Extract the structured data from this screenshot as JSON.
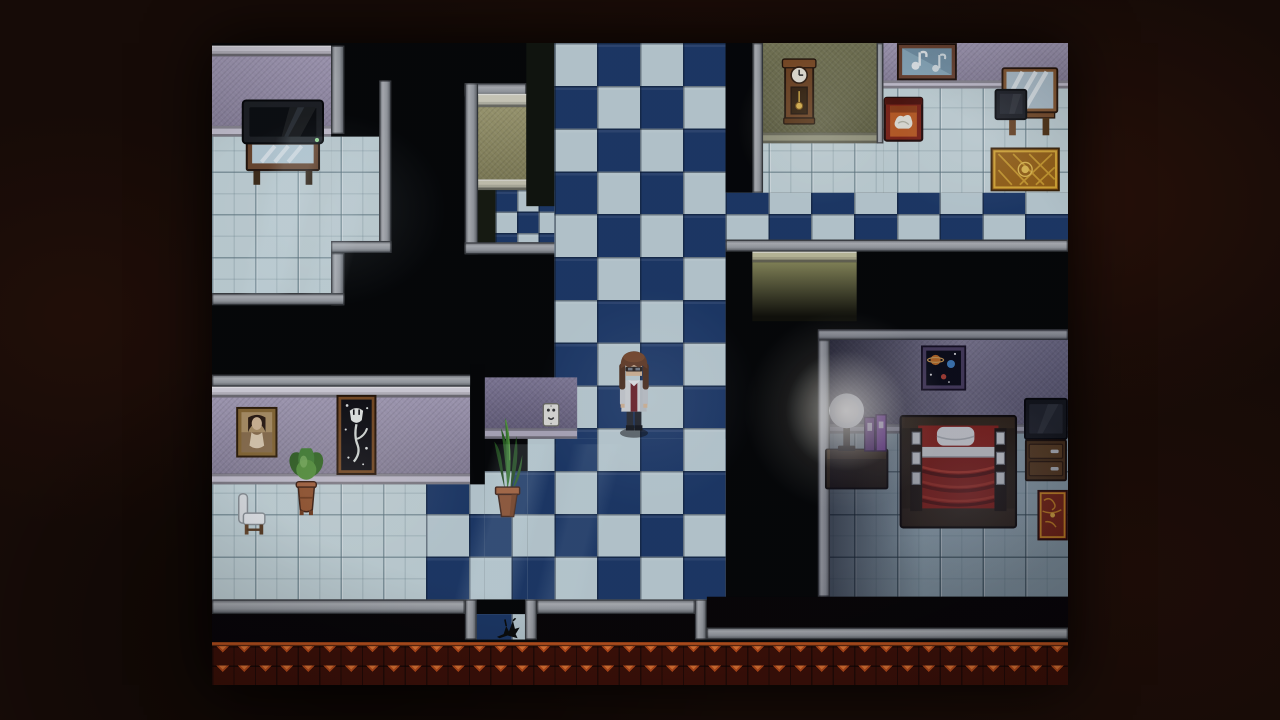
{
  "window": {
    "width": 1280,
    "height": 720,
    "game": {
      "x": 212,
      "y": 43,
      "w": 856,
      "h": 642,
      "native_w": 640,
      "native_h": 480,
      "scale": 1.3375
    }
  },
  "palette": {
    "letterbox": "#160b07",
    "void": "#050606",
    "checker_navy": "#1d3a6a",
    "checker_pale": "#c2d4da",
    "floor_pale": "#c9dade",
    "floor_olive": "#8f8f5e",
    "floor_dim": "#93a8b2",
    "wall_lavender": "#a79dbb",
    "wall_olive": "#70704a",
    "wall_bedroom_dark": "#3a3950",
    "wall_bedroom_light": "#8a84a0",
    "gray_border": "#a4a8ad",
    "roof_base": "#401005",
    "roof_shingle": "#c44e18",
    "roof_line": "#c8561c",
    "lamp_glow": "#fffaeb"
  },
  "regions": [
    {
      "name": "tvroom-wall-molding",
      "kind": "molding",
      "x": 0,
      "y": 2,
      "w": 89,
      "h": 8,
      "c": "#dbd8e2"
    },
    {
      "name": "tvroom-wall",
      "kind": "wall",
      "x": 0,
      "y": 10,
      "w": 89,
      "h": 52,
      "c": "#a79dbb"
    },
    {
      "name": "tvroom-wall-baseboard",
      "kind": "base",
      "x": 0,
      "y": 62,
      "w": 89,
      "h": 8,
      "c": "#ccc8d6"
    },
    {
      "name": "tvroom-wall-edge",
      "kind": "border",
      "o": "v",
      "x": 89,
      "y": 2,
      "w": 10,
      "h": 66
    },
    {
      "name": "tvroom-floor",
      "kind": "floor",
      "c": "pale",
      "x": 0,
      "y": 70,
      "w": 89,
      "h": 117
    },
    {
      "name": "tvroom-floor-ext",
      "kind": "floor",
      "c": "pale",
      "x": 89,
      "y": 70,
      "w": 36,
      "h": 80
    },
    {
      "name": "tvroom-border-right-upper",
      "kind": "border",
      "o": "v",
      "x": 125,
      "y": 28,
      "w": 9,
      "h": 129
    },
    {
      "name": "tvroom-border-step",
      "kind": "border",
      "o": "h",
      "x": 89,
      "y": 148,
      "w": 45,
      "h": 9
    },
    {
      "name": "tvroom-border-right-lower",
      "kind": "border",
      "o": "v",
      "x": 89,
      "y": 157,
      "w": 10,
      "h": 39
    },
    {
      "name": "tvroom-border-bottom",
      "kind": "border",
      "o": "h",
      "x": 0,
      "y": 187,
      "w": 99,
      "h": 9
    },
    {
      "name": "alcove-border-top",
      "kind": "border",
      "o": "h",
      "x": 189,
      "y": 30,
      "w": 46,
      "h": 10
    },
    {
      "name": "alcove-border-left",
      "kind": "border",
      "o": "v",
      "x": 189,
      "y": 30,
      "w": 10,
      "h": 128
    },
    {
      "name": "alcove-window-molding",
      "kind": "molding",
      "x": 199,
      "y": 38,
      "w": 36,
      "h": 10,
      "c": "#d8d6c4"
    },
    {
      "name": "alcove-window-wall",
      "kind": "wall",
      "x": 199,
      "y": 48,
      "w": 36,
      "h": 54,
      "c": "#9c9868"
    },
    {
      "name": "alcove-window-sill",
      "kind": "molding",
      "x": 199,
      "y": 102,
      "w": 36,
      "h": 8,
      "c": "#cfcdb8"
    },
    {
      "name": "alcove-dark-floor",
      "kind": "black",
      "x": 199,
      "y": 110,
      "w": 19,
      "h": 39,
      "c": "#171b10"
    },
    {
      "name": "alcove-checker",
      "kind": "checker16",
      "x": 212,
      "y": 110,
      "w": 44,
      "h": 39
    },
    {
      "name": "alcove-border-bottom",
      "kind": "border",
      "o": "h",
      "x": 189,
      "y": 149,
      "w": 84,
      "h": 9
    },
    {
      "name": "corridor-dark-strip",
      "kind": "black",
      "x": 235,
      "y": 0,
      "w": 21,
      "h": 122,
      "c": "#10140c"
    },
    {
      "name": "main-corridor-floor",
      "kind": "checker",
      "x": 256,
      "y": 0,
      "w": 128,
      "h": 416
    },
    {
      "name": "clockroom-notch",
      "kind": "black",
      "x": 384,
      "y": 0,
      "w": 20,
      "h": 112,
      "c": "#040506"
    },
    {
      "name": "clockroom-border-left",
      "kind": "border",
      "o": "v",
      "x": 404,
      "y": 0,
      "w": 8,
      "h": 112
    },
    {
      "name": "clockroom-wall",
      "kind": "wall",
      "x": 412,
      "y": 0,
      "w": 85,
      "h": 67,
      "c": "#70704a"
    },
    {
      "name": "clockroom-wall-baseboard",
      "kind": "base",
      "x": 412,
      "y": 67,
      "w": 85,
      "h": 8,
      "c": "#9a9a80"
    },
    {
      "name": "clockroom-floor",
      "kind": "floor",
      "c": "pale",
      "x": 412,
      "y": 75,
      "w": 90,
      "h": 37
    },
    {
      "name": "room-divider-edge",
      "kind": "border",
      "o": "v",
      "x": 497,
      "y": 0,
      "w": 5,
      "h": 75
    },
    {
      "name": "dresserroom-wall",
      "kind": "wall",
      "x": 502,
      "y": 0,
      "w": 138,
      "h": 28,
      "c": "#a79dbb"
    },
    {
      "name": "dresserroom-wall-baseboard",
      "kind": "base",
      "x": 502,
      "y": 28,
      "w": 138,
      "h": 6,
      "c": "#ccc8d6"
    },
    {
      "name": "dresserroom-floor",
      "kind": "floor",
      "c": "pale",
      "x": 502,
      "y": 34,
      "w": 138,
      "h": 78
    },
    {
      "name": "east-corridor-floor",
      "kind": "checker",
      "x": 384,
      "y": 112,
      "w": 256,
      "h": 35
    },
    {
      "name": "east-corridor-border",
      "kind": "border",
      "o": "h",
      "x": 384,
      "y": 147,
      "w": 256,
      "h": 9
    },
    {
      "name": "clockroom-southface-molding",
      "kind": "molding",
      "x": 404,
      "y": 156,
      "w": 78,
      "h": 8,
      "c": "#c6c4a0"
    },
    {
      "name": "clockroom-southface",
      "kind": "face",
      "x": 404,
      "y": 164,
      "w": 78,
      "h": 44,
      "c": "#8a8a5a"
    },
    {
      "name": "bedroom-border-top",
      "kind": "border",
      "o": "h",
      "x": 453,
      "y": 214,
      "w": 187,
      "h": 8
    },
    {
      "name": "bedroom-border-left",
      "kind": "border",
      "o": "v",
      "x": 453,
      "y": 222,
      "w": 9,
      "h": 192
    },
    {
      "name": "bedroom-wall",
      "kind": "wall",
      "x": 462,
      "y": 222,
      "w": 178,
      "h": 63,
      "g": "linear-gradient(to right,#3a3950,#8a84a0 55%,#6e6a88)"
    },
    {
      "name": "bedroom-wall-baseboard",
      "kind": "base",
      "x": 462,
      "y": 285,
      "w": 178,
      "h": 7,
      "c": "#a6a6b4"
    },
    {
      "name": "bedroom-floor",
      "kind": "floor",
      "c": "dim",
      "x": 462,
      "y": 292,
      "w": 178,
      "h": 122
    },
    {
      "name": "portraitroom-border-top",
      "kind": "border",
      "o": "h",
      "x": 0,
      "y": 248,
      "w": 196,
      "h": 9
    },
    {
      "name": "portraitroom-wall-molding",
      "kind": "molding",
      "x": 0,
      "y": 257,
      "w": 193,
      "h": 8,
      "c": "#dbd8e2"
    },
    {
      "name": "portraitroom-wall",
      "kind": "wall",
      "x": 0,
      "y": 265,
      "w": 193,
      "h": 57,
      "c": "#a39ab6"
    },
    {
      "name": "portraitroom-wall-baseboard",
      "kind": "base",
      "x": 0,
      "y": 322,
      "w": 193,
      "h": 8,
      "c": "#c9c5d3"
    },
    {
      "name": "door-gap",
      "kind": "black",
      "x": 193,
      "y": 240,
      "w": 11,
      "h": 90,
      "c": "#040505"
    },
    {
      "name": "outlet-wall",
      "kind": "wall",
      "x": 204,
      "y": 250,
      "w": 69,
      "h": 38,
      "c": "#7b7394"
    },
    {
      "name": "outlet-wall-baseboard",
      "kind": "base",
      "x": 204,
      "y": 288,
      "w": 69,
      "h": 8,
      "c": "#b4afc2"
    },
    {
      "name": "outlet-wall-shadow",
      "kind": "black",
      "x": 204,
      "y": 296,
      "w": 32,
      "h": 24,
      "c": "#050606"
    },
    {
      "name": "portraitroom-floor",
      "kind": "floor",
      "c": "pale",
      "x": 0,
      "y": 330,
      "w": 160,
      "h": 86
    },
    {
      "name": "south-checker-a",
      "kind": "checker",
      "x": 236,
      "y": 296,
      "w": 148,
      "h": 120
    },
    {
      "name": "south-checker-b",
      "kind": "checker",
      "x": 204,
      "y": 320,
      "w": 32,
      "h": 96
    },
    {
      "name": "south-checker-c",
      "kind": "checker",
      "x": 160,
      "y": 330,
      "w": 44,
      "h": 86
    },
    {
      "name": "bottom-border-left",
      "kind": "border",
      "o": "h",
      "x": 0,
      "y": 416,
      "w": 189,
      "h": 11
    },
    {
      "name": "exit-notch-border-left",
      "kind": "border",
      "o": "v",
      "x": 189,
      "y": 416,
      "w": 9,
      "h": 30
    },
    {
      "name": "exit-notch-floor",
      "kind": "checker",
      "x": 198,
      "y": 427,
      "w": 36,
      "h": 19
    },
    {
      "name": "exit-notch-border-right",
      "kind": "border",
      "o": "v",
      "x": 234,
      "y": 416,
      "w": 9,
      "h": 30
    },
    {
      "name": "bottom-border-mid",
      "kind": "border",
      "o": "h",
      "x": 243,
      "y": 416,
      "w": 118,
      "h": 11
    },
    {
      "name": "bottom-border-step",
      "kind": "border",
      "o": "v",
      "x": 361,
      "y": 416,
      "w": 9,
      "h": 30
    },
    {
      "name": "bottom-border-right",
      "kind": "border",
      "o": "h",
      "x": 370,
      "y": 437,
      "w": 270,
      "h": 9
    },
    {
      "name": "bottom-black-left",
      "kind": "black",
      "x": 0,
      "y": 427,
      "w": 189,
      "h": 21,
      "c": "#070405"
    },
    {
      "name": "bottom-black-mid",
      "kind": "black",
      "x": 243,
      "y": 427,
      "w": 118,
      "h": 21,
      "c": "#070405"
    },
    {
      "name": "bottom-black-right",
      "kind": "black",
      "x": 370,
      "y": 414,
      "w": 270,
      "h": 23,
      "c": "#070405"
    },
    {
      "name": "roof-edge",
      "kind": "roof",
      "x": 0,
      "y": 448,
      "w": 640,
      "h": 32
    }
  ],
  "sprites": [
    {
      "name": "tv-on-table",
      "kind": "tv_table",
      "x": 22,
      "y": 42,
      "w": 62,
      "h": 66
    },
    {
      "name": "grandfather-clock",
      "kind": "clock",
      "x": 425,
      "y": 10,
      "w": 28,
      "h": 52
    },
    {
      "name": "music-painting",
      "kind": "painting_music",
      "x": 512,
      "y": 0,
      "w": 45,
      "h": 28
    },
    {
      "name": "red-cabinet",
      "kind": "cabinet_red",
      "x": 502,
      "y": 40,
      "w": 30,
      "h": 34
    },
    {
      "name": "vanity-mirror",
      "kind": "vanity",
      "x": 585,
      "y": 18,
      "w": 48,
      "h": 52
    },
    {
      "name": "gold-rug",
      "kind": "rug_gold",
      "x": 582,
      "y": 78,
      "w": 52,
      "h": 33
    },
    {
      "name": "space-picture",
      "kind": "picture_space",
      "x": 530,
      "y": 226,
      "w": 34,
      "h": 34
    },
    {
      "name": "lamp-nightstand",
      "kind": "lamp_set",
      "x": 458,
      "y": 256,
      "w": 48,
      "h": 82
    },
    {
      "name": "bed",
      "kind": "bed",
      "x": 514,
      "y": 278,
      "w": 88,
      "h": 85
    },
    {
      "name": "tv-dresser",
      "kind": "tv_dresser",
      "x": 607,
      "y": 265,
      "w": 33,
      "h": 65
    },
    {
      "name": "red-rug",
      "kind": "rug_red",
      "x": 617,
      "y": 334,
      "w": 23,
      "h": 38
    },
    {
      "name": "woman-portrait",
      "kind": "portrait",
      "x": 18,
      "y": 272,
      "w": 31,
      "h": 38
    },
    {
      "name": "tulip-painting",
      "kind": "tulip",
      "x": 93,
      "y": 263,
      "w": 30,
      "h": 60
    },
    {
      "name": "potted-plant",
      "kind": "plant_bush",
      "x": 57,
      "y": 303,
      "w": 27,
      "h": 51
    },
    {
      "name": "white-chair",
      "kind": "chair_white",
      "x": 19,
      "y": 336,
      "w": 22,
      "h": 33
    },
    {
      "name": "snake-plant",
      "kind": "plant_snake",
      "x": 208,
      "y": 274,
      "w": 26,
      "h": 82
    },
    {
      "name": "wall-outlet",
      "kind": "outlet",
      "x": 247,
      "y": 269,
      "w": 13,
      "h": 18
    },
    {
      "name": "floor-crack",
      "kind": "crack",
      "x": 211,
      "y": 430,
      "w": 20,
      "h": 16
    },
    {
      "name": "player-character",
      "kind": "character",
      "x": 302,
      "y": 228,
      "w": 27,
      "h": 68,
      "interactable": true
    }
  ],
  "overlays": [
    {
      "name": "tvroom-window-streak",
      "kind": "streak",
      "x": 0,
      "y": 70,
      "w": 131,
      "h": 118
    },
    {
      "name": "south-floor-streak",
      "kind": "streak",
      "x": 150,
      "y": 300,
      "w": 170,
      "h": 116
    },
    {
      "name": "tvroom-light",
      "kind": "glow",
      "x": 0,
      "y": 52,
      "w": 175,
      "h": 145,
      "c": "rgba(205,228,240,.12)"
    },
    {
      "name": "clockroom-light",
      "kind": "glow",
      "x": 393,
      "y": 3,
      "w": 122,
      "h": 118,
      "c": "rgba(255,252,225,.16)"
    },
    {
      "name": "dresserroom-light",
      "kind": "glow",
      "x": 492,
      "y": 0,
      "w": 165,
      "h": 128,
      "c": "rgba(215,220,245,.14)"
    },
    {
      "name": "corridor-light",
      "kind": "glow",
      "x": 243,
      "y": 183,
      "w": 165,
      "h": 165,
      "c": "rgba(195,205,240,.11)"
    },
    {
      "name": "portraitroom-light",
      "kind": "glow",
      "x": 3,
      "y": 253,
      "w": 195,
      "h": 155,
      "c": "rgba(255,242,225,.12)"
    },
    {
      "name": "bedroom-left-shadow",
      "kind": "shade",
      "x": 462,
      "y": 222,
      "w": 70,
      "h": 192,
      "g": "linear-gradient(to right, rgba(0,0,15,.5), rgba(0,0,15,0))"
    },
    {
      "name": "bedroom-dim",
      "kind": "shade",
      "x": 453,
      "y": 214,
      "w": 187,
      "h": 200,
      "g": "linear-gradient(rgba(8,8,28,.18),rgba(8,8,28,.18))"
    },
    {
      "name": "bed-light",
      "kind": "glow",
      "x": 480,
      "y": 260,
      "w": 170,
      "h": 150,
      "c": "rgba(185,195,225,.14)"
    },
    {
      "name": "lamp-glow-halo",
      "kind": "glow",
      "x": 398,
      "y": 200,
      "w": 150,
      "h": 150,
      "c": "rgba(255,248,230,.22)"
    },
    {
      "name": "lamp-glow-core",
      "kind": "glow",
      "x": 429,
      "y": 230,
      "w": 90,
      "h": 90,
      "c": "rgba(255,250,235,.55)"
    },
    {
      "name": "scene-vignette",
      "kind": "vignette",
      "x": 0,
      "y": 0,
      "w": 640,
      "h": 480
    }
  ]
}
